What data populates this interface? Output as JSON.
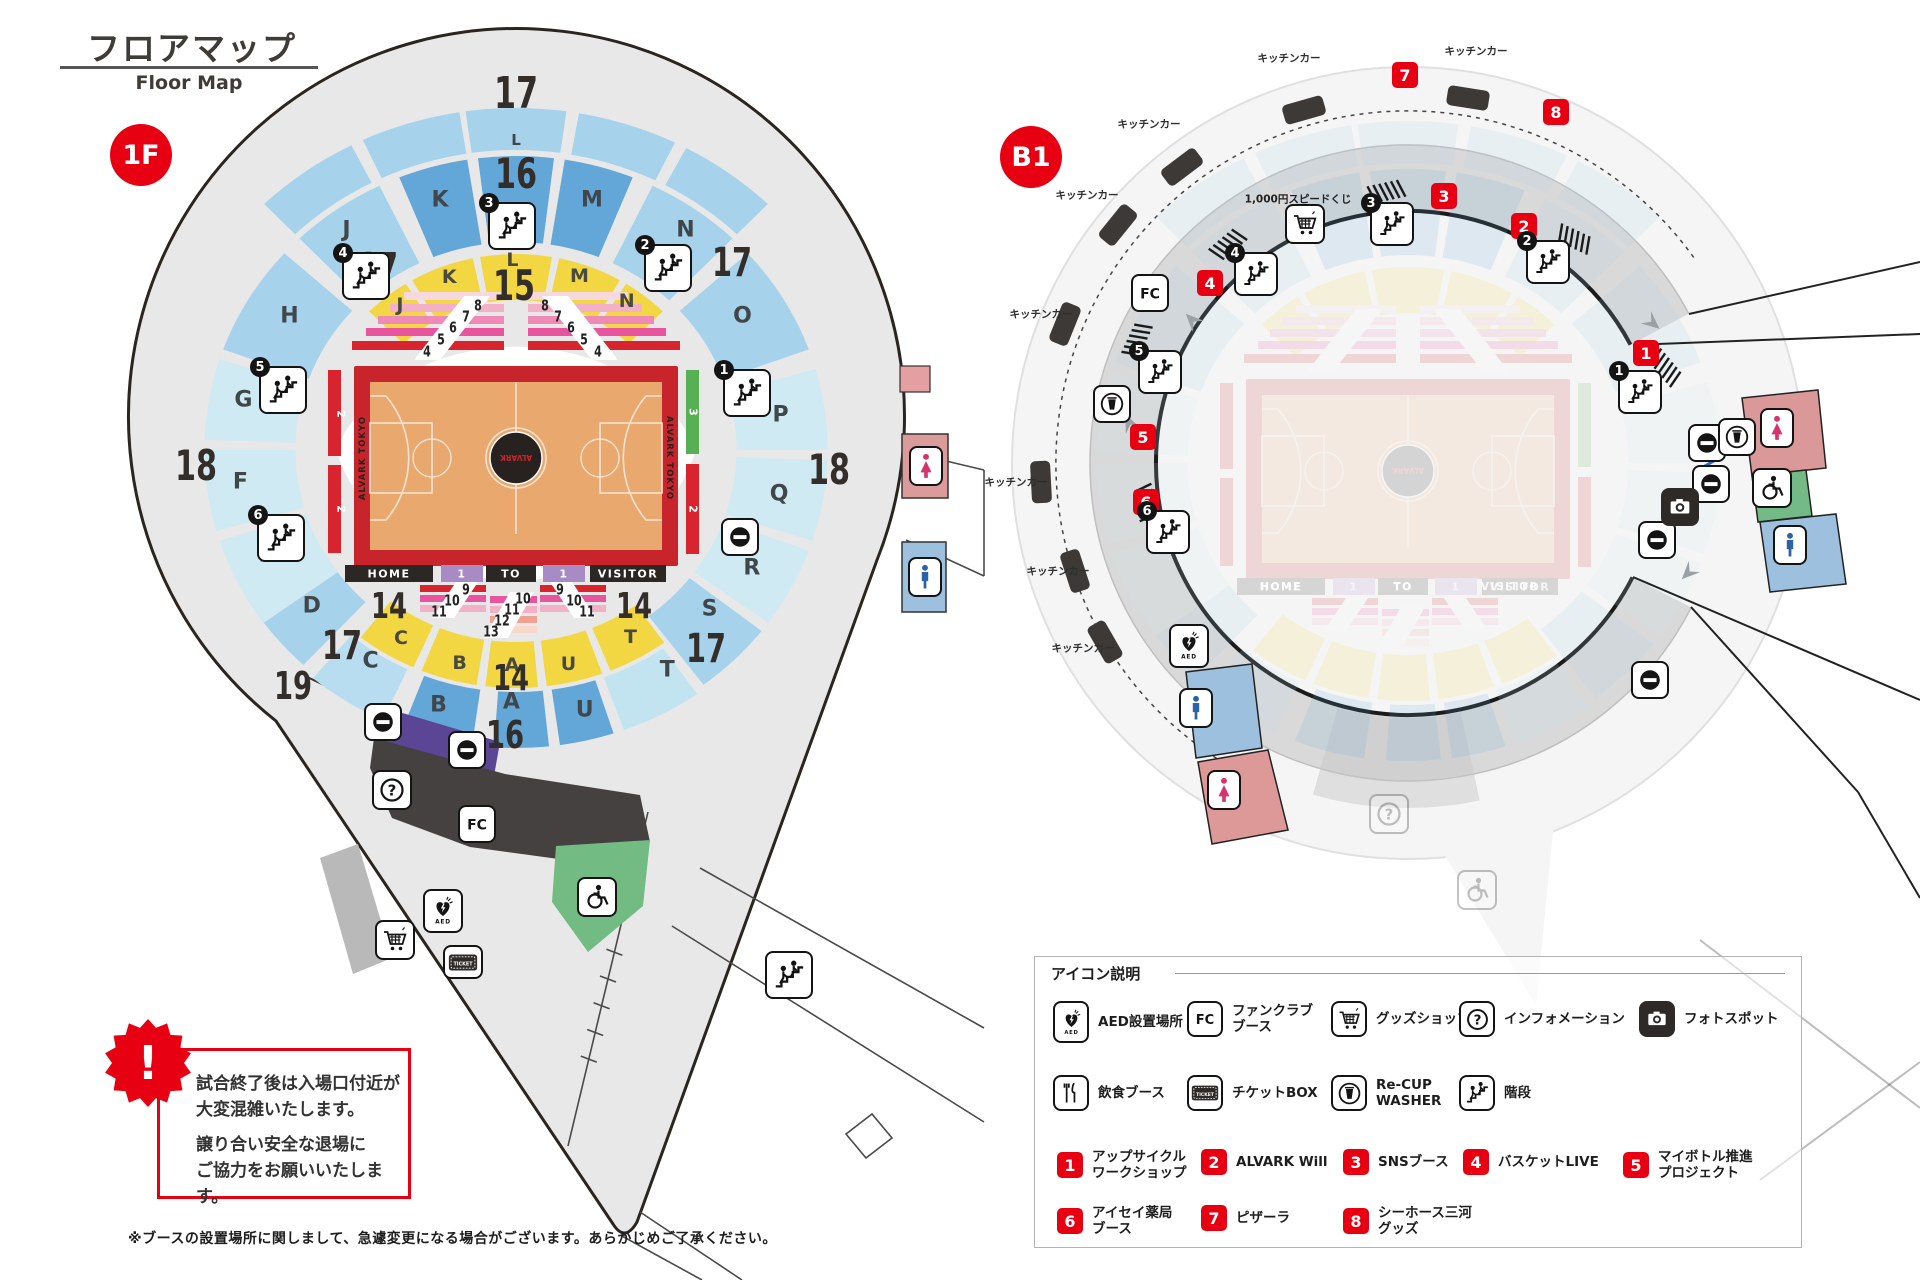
{
  "header": {
    "title_jp": "フロアマップ",
    "title_en": "Floor Map"
  },
  "floors": {
    "f1": "1F",
    "b1": "B1"
  },
  "colors": {
    "accent": "#e60012",
    "blue_mid": "#63a6d8",
    "blue_light": "#a6d2ec",
    "cyan_pale": "#cfeaf2",
    "yellow": "#f2d743",
    "court": "#e9a96e",
    "court_border": "#c8242b",
    "purple": "#5a4694",
    "premium_purple": "#a78bc4",
    "green": "#72bb83",
    "bowl_gray": "#e8e8e8"
  },
  "court": {
    "home": "HOME",
    "to": "TO",
    "visitor": "VISITOR",
    "side_text": "ALVARK TOKYO",
    "logo": "ALVARK",
    "premium": "1",
    "rows_top": [
      "4",
      "5",
      "6",
      "7",
      "8"
    ],
    "rows_bottom_side": [
      "9",
      "10",
      "11"
    ],
    "rows_bottom_center": [
      "10",
      "11",
      "12",
      "13"
    ],
    "strip_left": [
      "2",
      "2"
    ],
    "strip_right": [
      "3",
      "2"
    ]
  },
  "arena": {
    "bandA_label": "L",
    "bandB": [
      {
        "l": "H",
        "a": [
          -70,
          -48
        ],
        "c": "lb",
        "lp": [
          -58,
          252
        ]
      },
      {
        "l": "J",
        "a": [
          -44,
          -26
        ],
        "c": "lb",
        "lp": [
          -36,
          272
        ]
      },
      {
        "l": "K",
        "a": [
          -22,
          -9
        ],
        "c": "mb",
        "lp": [
          -16,
          260
        ]
      },
      {
        "l": "",
        "a": [
          -7,
          7
        ],
        "c": "mb",
        "lp": [
          0,
          260
        ]
      },
      {
        "l": "M",
        "a": [
          9,
          22
        ],
        "c": "mb",
        "lp": [
          16,
          260
        ]
      },
      {
        "l": "N",
        "a": [
          26,
          44
        ],
        "c": "lb",
        "lp": [
          36,
          272
        ]
      },
      {
        "l": "O",
        "a": [
          48,
          70
        ],
        "c": "lb",
        "lp": [
          58,
          252
        ]
      },
      {
        "l": "P",
        "a": [
          74,
          90
        ],
        "c": "pc",
        "lp": [
          82,
          252
        ]
      },
      {
        "l": "Q",
        "a": [
          92,
          108
        ],
        "c": "pc",
        "lp": [
          100,
          252
        ]
      },
      {
        "l": "R",
        "a": [
          110,
          126
        ],
        "c": "pc",
        "lp": [
          118,
          252
        ]
      },
      {
        "l": "S",
        "a": [
          128,
          143
        ],
        "c": "lb",
        "lp": [
          131,
          242
        ]
      },
      {
        "l": "T",
        "a": [
          145,
          160
        ],
        "c": "pc2",
        "bot": true,
        "lp": [
          147,
          262
        ]
      },
      {
        "l": "U",
        "a": [
          162,
          172
        ],
        "c": "mb",
        "bot": true,
        "lp": [
          166,
          268
        ]
      },
      {
        "l": "A",
        "a": [
          174,
          184
        ],
        "c": "mb",
        "bot": true,
        "lp": [
          181,
          252
        ]
      },
      {
        "l": "B",
        "a": [
          188,
          201
        ],
        "c": "mb",
        "bot": true,
        "lp": [
          196,
          265
        ]
      },
      {
        "l": "C",
        "a": [
          205,
          220
        ],
        "c": "lb2",
        "bot": true,
        "lp": [
          213,
          252
        ]
      },
      {
        "l": "D",
        "a": [
          223,
          240
        ],
        "c": "lb",
        "lp": [
          231,
          248
        ]
      },
      {
        "l": "E",
        "a": [
          -126,
          -108
        ],
        "c": "pc",
        "lp": [
          -114,
          258
        ]
      },
      {
        "l": "F",
        "a": [
          -106,
          -90
        ],
        "c": "pc",
        "lp": [
          -97,
          262
        ]
      },
      {
        "l": "G",
        "a": [
          -88,
          -72
        ],
        "c": "pc",
        "lp": [
          -79,
          262
        ]
      }
    ],
    "yellow": [
      {
        "l": "J",
        "a": [
          -45,
          -32
        ],
        "lp": [
          -37,
          182
        ]
      },
      {
        "l": "K",
        "a": [
          -30,
          -12
        ],
        "lp": [
          -20,
          184
        ]
      },
      {
        "l": "L",
        "a": [
          -10,
          10
        ],
        "lp": [
          -1,
          190
        ]
      },
      {
        "l": "M",
        "a": [
          12,
          30
        ],
        "lp": [
          19,
          184
        ]
      },
      {
        "l": "N",
        "a": [
          32,
          45
        ],
        "lp": [
          35,
          182
        ]
      },
      {
        "l": "T",
        "a": [
          144,
          158
        ],
        "bot": true,
        "lp": [
          150,
          216
        ]
      },
      {
        "l": "U",
        "a": [
          160,
          173
        ],
        "bot": true,
        "lp": [
          167,
          220
        ]
      },
      {
        "l": "A",
        "a": [
          175,
          187
        ],
        "bot": true,
        "lp": [
          181,
          215
        ]
      },
      {
        "l": "B",
        "a": [
          189,
          202
        ],
        "bot": true,
        "lp": [
          194,
          220
        ]
      },
      {
        "l": "C",
        "a": [
          204,
          218
        ],
        "bot": true,
        "lp": [
          210,
          217
        ]
      }
    ]
  },
  "map_1f": {
    "zone_numbers": [
      {
        "t": "17",
        "x": 516,
        "y": 94,
        "s": 44
      },
      {
        "t": "16",
        "x": 516,
        "y": 174,
        "s": 42
      },
      {
        "t": "15",
        "x": 514,
        "y": 286,
        "s": 42
      },
      {
        "t": "17",
        "x": 378,
        "y": 268,
        "s": 40
      },
      {
        "t": "17",
        "x": 732,
        "y": 263,
        "s": 40
      },
      {
        "t": "18",
        "x": 196,
        "y": 466,
        "s": 42
      },
      {
        "t": "18",
        "x": 829,
        "y": 470,
        "s": 42
      },
      {
        "t": "17",
        "x": 342,
        "y": 646,
        "s": 40
      },
      {
        "t": "17",
        "x": 706,
        "y": 649,
        "s": 40
      },
      {
        "t": "19",
        "x": 293,
        "y": 686,
        "s": 38
      },
      {
        "t": "14",
        "x": 389,
        "y": 607,
        "s": 36
      },
      {
        "t": "14",
        "x": 511,
        "y": 679,
        "s": 36
      },
      {
        "t": "14",
        "x": 634,
        "y": 607,
        "s": 36
      },
      {
        "t": "16",
        "x": 505,
        "y": 735,
        "s": 38
      }
    ],
    "stairs": [
      {
        "n": "1",
        "x": 747,
        "y": 393
      },
      {
        "n": "2",
        "x": 668,
        "y": 268
      },
      {
        "n": "3",
        "x": 512,
        "y": 226
      },
      {
        "n": "4",
        "x": 366,
        "y": 276
      },
      {
        "n": "5",
        "x": 283,
        "y": 390
      },
      {
        "n": "6",
        "x": 281,
        "y": 538
      }
    ],
    "noentry": [
      {
        "x": 740,
        "y": 537
      },
      {
        "x": 383,
        "y": 722
      },
      {
        "x": 467,
        "y": 750
      }
    ],
    "tiles": [
      {
        "t": "info",
        "x": 392,
        "y": 790
      },
      {
        "t": "fc",
        "x": 477,
        "y": 824
      },
      {
        "t": "wheel",
        "x": 597,
        "y": 897
      },
      {
        "t": "cart",
        "x": 395,
        "y": 940
      },
      {
        "t": "stairsPlain",
        "x": 789,
        "y": 975
      },
      {
        "t": "aed",
        "x": 443,
        "y": 911
      },
      {
        "t": "ticket",
        "x": 463,
        "y": 962
      },
      {
        "t": "personPink",
        "x": 926,
        "y": 466
      },
      {
        "t": "personBlue",
        "x": 925,
        "y": 577
      }
    ]
  },
  "map_b1": {
    "kitchen_label": "キッチンカー",
    "lottery_label": "1,000円スピードくじ",
    "kitchen_cars": [
      {
        "lx": 1476,
        "ly": 51,
        "x": 1468,
        "y": 98,
        "r": 9
      },
      {
        "lx": 1289,
        "ly": 58,
        "x": 1304,
        "y": 110,
        "r": -16
      },
      {
        "lx": 1149,
        "ly": 124,
        "x": 1182,
        "y": 167,
        "r": -37
      },
      {
        "lx": 1087,
        "ly": 195,
        "x": 1118,
        "y": 225,
        "r": -51
      },
      {
        "lx": 1041,
        "ly": 314,
        "x": 1065,
        "y": 324,
        "r": -68
      },
      {
        "lx": 1016,
        "ly": 482,
        "x": 1041,
        "y": 482,
        "r": -93
      },
      {
        "lx": 1058,
        "ly": 571,
        "x": 1075,
        "y": 571,
        "r": -108
      },
      {
        "lx": 1083,
        "ly": 648,
        "x": 1105,
        "y": 642,
        "r": -120
      }
    ],
    "badges": [
      {
        "n": "1",
        "x": 1646,
        "y": 353
      },
      {
        "n": "2",
        "x": 1524,
        "y": 226
      },
      {
        "n": "3",
        "x": 1444,
        "y": 196
      },
      {
        "n": "4",
        "x": 1210,
        "y": 283
      },
      {
        "n": "5",
        "x": 1143,
        "y": 437
      },
      {
        "n": "6",
        "x": 1146,
        "y": 502
      },
      {
        "n": "7",
        "x": 1405,
        "y": 75
      },
      {
        "n": "8",
        "x": 1556,
        "y": 112
      }
    ],
    "stairs": [
      {
        "n": "1",
        "x": 1640,
        "y": 392
      },
      {
        "n": "2",
        "x": 1548,
        "y": 262
      },
      {
        "n": "3",
        "x": 1392,
        "y": 224
      },
      {
        "n": "4",
        "x": 1256,
        "y": 274
      },
      {
        "n": "5",
        "x": 1160,
        "y": 372
      },
      {
        "n": "6",
        "x": 1168,
        "y": 532
      }
    ],
    "noentry": [
      {
        "x": 1707,
        "y": 443
      },
      {
        "x": 1711,
        "y": 484
      },
      {
        "x": 1657,
        "y": 540
      },
      {
        "x": 1650,
        "y": 680
      }
    ],
    "tiles": [
      {
        "t": "fc",
        "x": 1150,
        "y": 293
      },
      {
        "t": "cart",
        "x": 1305,
        "y": 224
      },
      {
        "t": "recup",
        "x": 1112,
        "y": 404
      },
      {
        "t": "aed",
        "x": 1189,
        "y": 646
      },
      {
        "t": "cameraB",
        "x": 1680,
        "y": 507
      },
      {
        "t": "recup",
        "x": 1737,
        "y": 437
      },
      {
        "t": "personBlue",
        "x": 1196,
        "y": 708
      },
      {
        "t": "personPink",
        "x": 1224,
        "y": 790
      },
      {
        "t": "personPink",
        "x": 1777,
        "y": 428
      },
      {
        "t": "wheel",
        "x": 1772,
        "y": 488
      },
      {
        "t": "personBlue",
        "x": 1790,
        "y": 545
      },
      {
        "t": "infoGhost",
        "x": 1389,
        "y": 814
      },
      {
        "t": "wheelGhost",
        "x": 1477,
        "y": 890
      }
    ]
  },
  "legend": {
    "title": "アイコン説明",
    "icon_items": [
      {
        "icon": "aed",
        "label": "AED設置場所"
      },
      {
        "icon": "fc",
        "label": "ファンクラブ\nブース"
      },
      {
        "icon": "cart",
        "label": "グッズショップ"
      },
      {
        "icon": "info",
        "label": "インフォメーション"
      },
      {
        "icon": "cameraB",
        "label": "フォトスポット"
      },
      {
        "icon": "food",
        "label": "飲食ブース"
      },
      {
        "icon": "ticket",
        "label": "チケットBOX"
      },
      {
        "icon": "recup",
        "label": "Re-CUP\nWASHER"
      },
      {
        "icon": "stairsPlain",
        "label": "階段"
      }
    ],
    "booth_items": [
      {
        "n": "1",
        "label": "アップサイクル\nワークショップ"
      },
      {
        "n": "2",
        "label": "ALVARK Will"
      },
      {
        "n": "3",
        "label": "SNSブース"
      },
      {
        "n": "4",
        "label": "バスケットLIVE"
      },
      {
        "n": "5",
        "label": "マイボトル推進\nプロジェクト"
      },
      {
        "n": "6",
        "label": "アイセイ薬局\nブース"
      },
      {
        "n": "7",
        "label": "ピザーラ"
      },
      {
        "n": "8",
        "label": "シーホース三河\nグッズ"
      }
    ]
  },
  "warning": {
    "mark": "!",
    "para1": [
      "試合終了後は入場口付近が",
      "大変混雑いたします。"
    ],
    "para2": [
      "譲り合い安全な退場に",
      "ご協力をお願いいたします。"
    ]
  },
  "footnote": "※ブースの設置場所に関しまして、急遽変更になる場合がございます。あらかじめご了承ください。"
}
